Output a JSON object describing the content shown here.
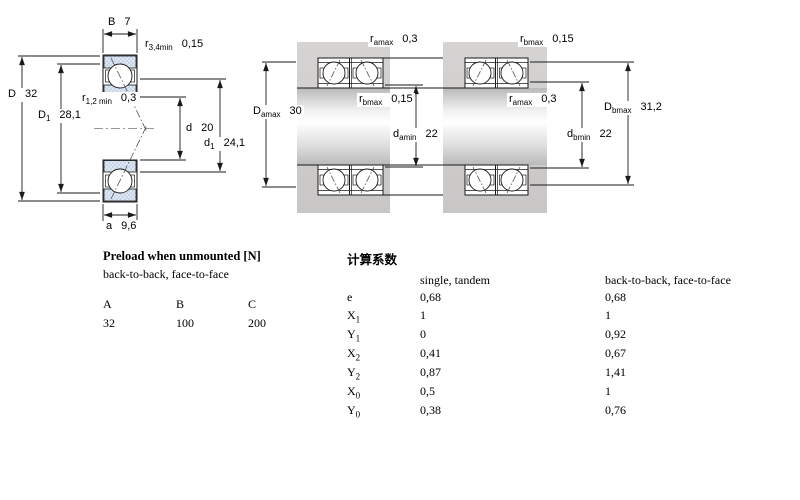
{
  "drawing": {
    "single": {
      "b": {
        "base": "B",
        "sub": "",
        "value": "7"
      },
      "r34": {
        "base": "r",
        "sub": "3,4min",
        "value": "0,15"
      },
      "D": {
        "base": "D",
        "sub": "",
        "value": "32"
      },
      "D1": {
        "base": "D",
        "sub": "1",
        "value": "28,1"
      },
      "r12": {
        "base": "r",
        "sub": "1,2 min",
        "value": "0,3"
      },
      "d": {
        "base": "d",
        "sub": "",
        "value": "20"
      },
      "d1": {
        "base": "d",
        "sub": "1",
        "value": "24,1"
      },
      "a": {
        "base": "a",
        "sub": "",
        "value": "9,6"
      }
    },
    "pair_a": {
      "ramax": {
        "base": "r",
        "sub": "amax",
        "value": "0,3"
      },
      "Damax": {
        "base": "D",
        "sub": "amax",
        "value": "30"
      },
      "rbmax": {
        "base": "r",
        "sub": "bmax",
        "value": "0,15"
      },
      "damin": {
        "base": "d",
        "sub": "amin",
        "value": "22"
      }
    },
    "pair_b": {
      "rbmax": {
        "base": "r",
        "sub": "bmax",
        "value": "0,15"
      },
      "ramax": {
        "base": "r",
        "sub": "amax",
        "value": "0,3"
      },
      "Dbmax": {
        "base": "D",
        "sub": "bmax",
        "value": "31,2"
      },
      "dbmin": {
        "base": "d",
        "sub": "bmin",
        "value": "22"
      }
    }
  },
  "preload": {
    "title": "Preload when unmounted [N]",
    "subtitle": "back-to-back, face-to-face",
    "columns": [
      "A",
      "B",
      "C"
    ],
    "values": [
      "32",
      "100",
      "200"
    ]
  },
  "factors": {
    "title": "计算系数",
    "col1_header": "single, tandem",
    "col2_header": "back-to-back, face-to-face",
    "rows": [
      {
        "base": "e",
        "sub": "",
        "v1": "0,68",
        "v2": "0,68"
      },
      {
        "base": "X",
        "sub": "1",
        "v1": "1",
        "v2": "1"
      },
      {
        "base": "Y",
        "sub": "1",
        "v1": "0",
        "v2": "0,92"
      },
      {
        "base": "X",
        "sub": "2",
        "v1": "0,41",
        "v2": "0,67"
      },
      {
        "base": "Y",
        "sub": "2",
        "v1": "0,87",
        "v2": "1,41"
      },
      {
        "base": "X",
        "sub": "0",
        "v1": "0,5",
        "v2": "1"
      },
      {
        "base": "Y",
        "sub": "0",
        "v1": "0,38",
        "v2": "0,76"
      }
    ]
  },
  "colors": {
    "ring_blue": "#c9d6ea",
    "housing_gray": "#d0cdcd",
    "line_black": "#1a1a1a"
  }
}
